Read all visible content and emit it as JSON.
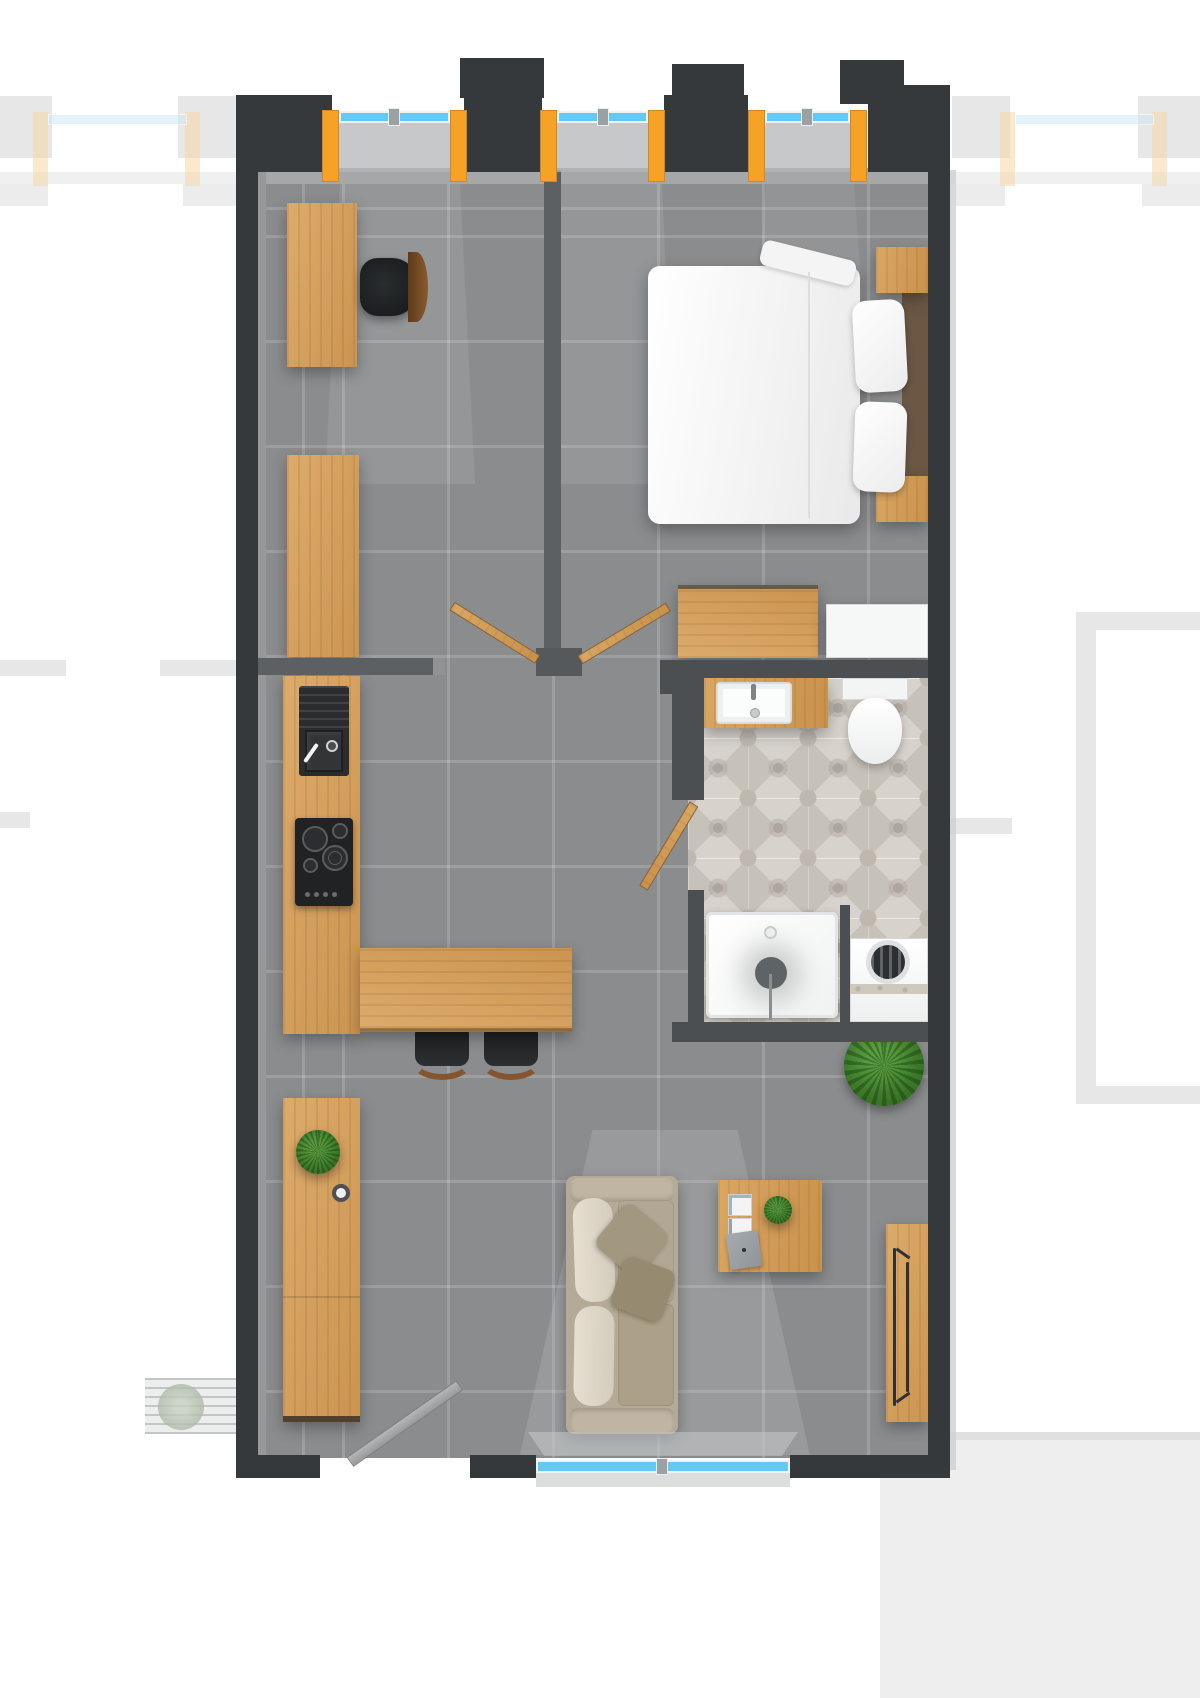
{
  "meta": {
    "kind": "architectural-floor-plan",
    "view": "top-down studio apartment render",
    "visible_text": "none"
  },
  "colors": {
    "wall-dark": "#36393c",
    "wall-mid": "#5c6063",
    "wall-bath": "#4b4f52",
    "wall-cap": "#909294",
    "floor": "#8a8c8e",
    "wood": "#d4a162",
    "wood-deep": "#c08c49",
    "wood-edge": "#5f4a33",
    "orange": "#f5a226",
    "glass": "#63c9f2",
    "white-fixture": "#f6f7f7",
    "bath-tile": "#d7d2cc",
    "sofa-body": "#b5aa97",
    "sofa-cushion": "#ddd6c7",
    "sofa-pillow": "#a2977f",
    "bed-linen": "#f7f7f7",
    "headboard": "#6b5744",
    "plant": "#3e7c2a",
    "appliance-black": "#222426",
    "stool-wood": "#84552f",
    "door-gray": "#a5a7a9",
    "neighbor": "#d3d4d5",
    "pale-orange": "#f8d7a4",
    "pale-blue": "#cfe9f6",
    "slab": "#a5a7a9"
  },
  "labels": {
    "canvas": "Studio apartment floor plan",
    "floor": "Gray tiled floor",
    "bed": "Double bed with white duvet",
    "pillow": "Pillow",
    "headboard": "Dark wood headboard",
    "nightstand": "Nightstand",
    "dresser": "Wooden dresser",
    "wardrobe": "White wardrobe cabinet",
    "desk": "Wooden desk",
    "desk_chair": "Office chair",
    "tall_cabinet": "Tall wooden cabinet",
    "kitchen_counter": "Kitchen counter",
    "kitchen_sink": "Kitchen sink with faucet",
    "cooktop": "Four burner cooktop",
    "breakfast_bar": "Breakfast bar counter",
    "bar_stool": "Bar stool",
    "sideboard": "Wooden sideboard",
    "sofa": "Three seat sofa",
    "coffee_table": "Coffee table",
    "laptop": "Laptop",
    "magazines": "Magazines",
    "plant_small": "Small plant",
    "plant_large": "Round floor plant",
    "console_table": "Wall console table",
    "vanity": "Bathroom vanity with sink",
    "toilet": "Toilet",
    "shower": "Walk-in shower tray",
    "washing_machine": "Washing machine",
    "bathroom_floor": "Patterned bathroom tile floor",
    "bathroom_door": "Bathroom door (open)",
    "bedroom_doors": "Double doors (open)",
    "entrance_door": "Entrance door (open)",
    "window": "Window with orange frame",
    "bottom_window": "Bottom window",
    "neighbor": "Adjacent unit structure (faded)",
    "walkway": "Exterior walkway with plants",
    "wall": "Wall"
  }
}
